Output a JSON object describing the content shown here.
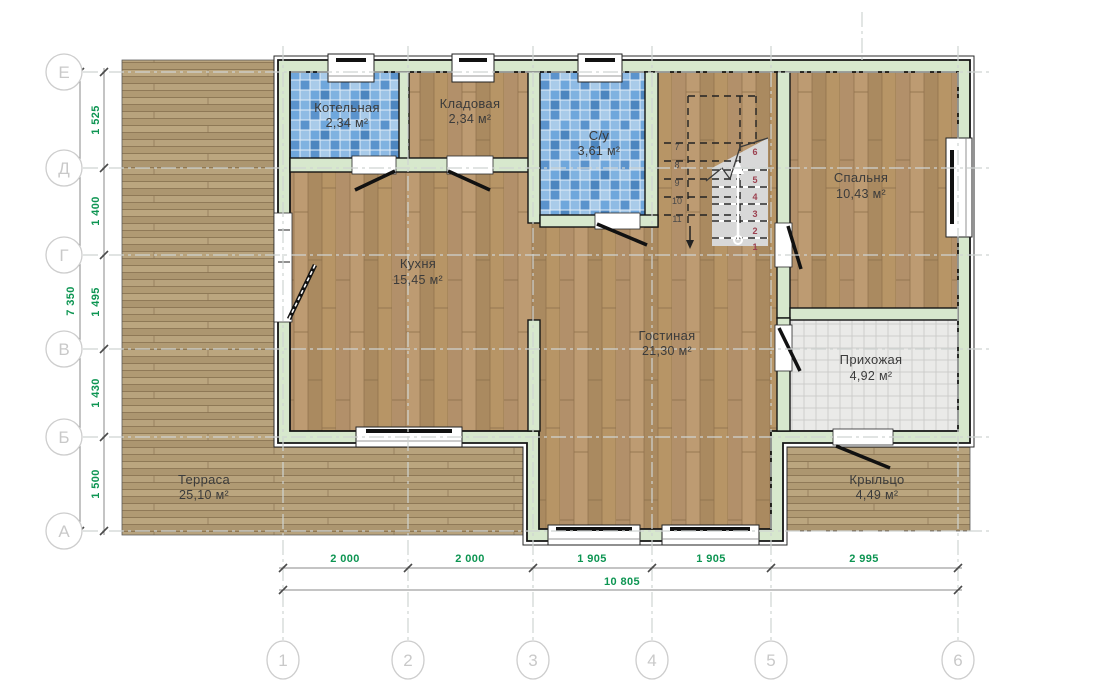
{
  "plan": {
    "rooms": [
      {
        "name": "Котельная",
        "area": "2,34 м²"
      },
      {
        "name": "Кладовая",
        "area": "2,34 м²"
      },
      {
        "name": "С/у",
        "area": "3,61 м²"
      },
      {
        "name": "Спальня",
        "area": "10,43 м²"
      },
      {
        "name": "Кухня",
        "area": "15,45 м²"
      },
      {
        "name": "Гостиная",
        "area": "21,30 м²"
      },
      {
        "name": "Прихожая",
        "area": "4,92 м²"
      },
      {
        "name": "Терраса",
        "area": "25,10 м²"
      },
      {
        "name": "Крыльцо",
        "area": "4,49 м²"
      }
    ],
    "axes": {
      "rows": [
        "Е",
        "Д",
        "Г",
        "В",
        "Б",
        "А"
      ],
      "cols": [
        "1",
        "2",
        "3",
        "4",
        "5",
        "6"
      ]
    },
    "dimensions": {
      "left_segments": [
        "1 525",
        "1 400",
        "1 495",
        "1 430",
        "1 500"
      ],
      "left_total": "7 350",
      "bottom_segments": [
        "2 000",
        "2 000",
        "1 905",
        "1 905",
        "2 995"
      ],
      "bottom_total": "10 805"
    },
    "stairs": {
      "upper_steps": [
        "7",
        "8",
        "9",
        "10",
        "11"
      ],
      "lower_steps": [
        "1",
        "2",
        "3",
        "4",
        "5",
        "6"
      ]
    },
    "colors": {
      "wall": "#d7e8cd",
      "tile_blue": "#6fa7dc",
      "tile_gray": "#eaeae8",
      "wood": "#b5946a",
      "deck": "#b49d78",
      "dimension_text": "#0d9552",
      "grid": "#cfd4d2",
      "stair_number": "#9c4150"
    }
  }
}
